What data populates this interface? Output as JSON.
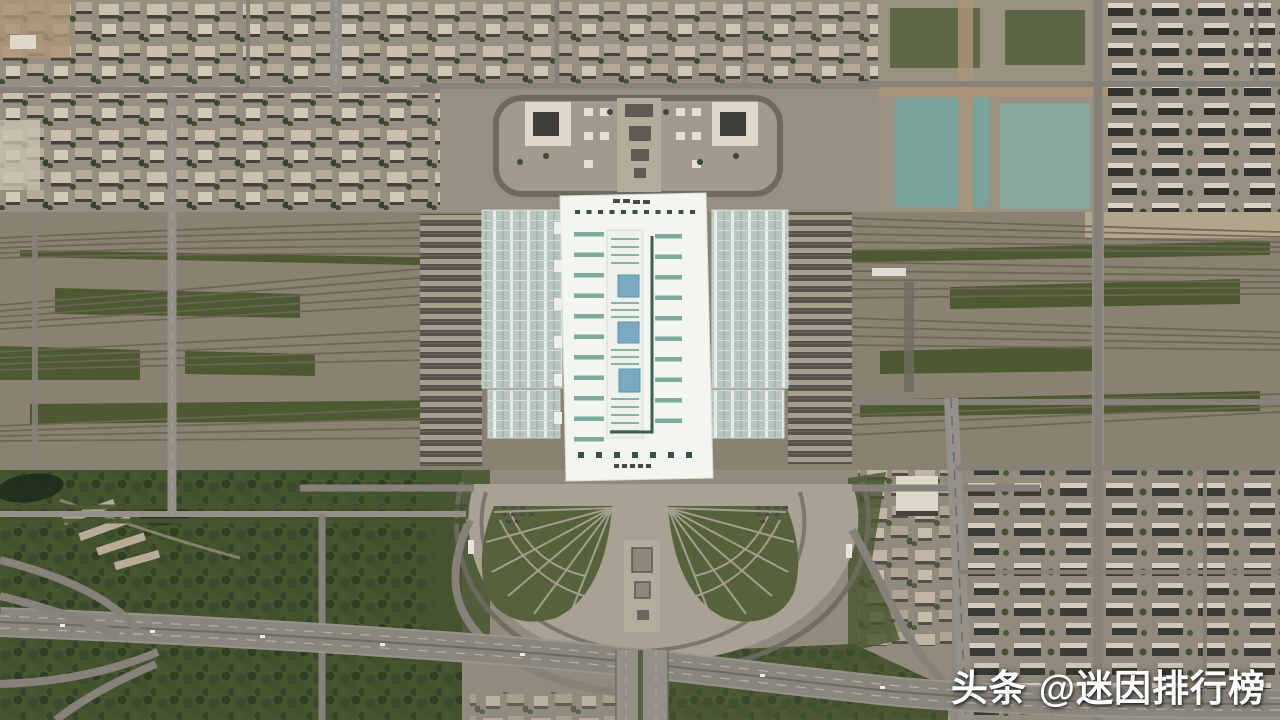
{
  "watermark": {
    "brand": "头条",
    "handle": "@迷因排行榜"
  },
  "scene": {
    "type": "satellite-aerial-photo",
    "subject": "large-railway-station-with-fanning-tracks-and-city"
  },
  "palette": {
    "base": "#928a7d",
    "urbanTop": "#978f82",
    "railBed": "#8b8173",
    "railLine": "#6d6456",
    "greenStrip": "#4d5a31",
    "forest": "#47552f",
    "pond": "#232d1d",
    "roadLight": "#94908a",
    "roadMid": "#86827a",
    "roadDark": "#6e6a62",
    "highway": "#8a867e",
    "laneLine": "#b3b0a8",
    "plaza": "#a8a194",
    "plazaInner": "#a29a8d",
    "promenade": "#b3ab9b",
    "gardenGreen": "#55623c",
    "gardenPath": "#aba496",
    "roofWhite": "#f3f5ef",
    "roofStripe": "#7fab9e",
    "roofDarkLine": "#3d5e52",
    "roofVent": "#4a4843",
    "roofSquare": "#3a4f47",
    "skylight": "#79aac2",
    "centralStrip": "#eef1ea",
    "canopy": "#b7c5be",
    "canopyLine": "#d5ddd6",
    "canopyMullion": "#e6ece7",
    "canopyDark": "#a3b7ae",
    "platformDark": "#57534b",
    "platformLight": "#a69e90",
    "blockLight": "#cbbfae",
    "blockMid": "#b7ab9a",
    "blockPale": "#d3c9b7",
    "shadow": "#45423b",
    "buildingWhite": "#ded8cb",
    "buildingCore": "#3f3d38",
    "dirt": "#ab9478",
    "construction": "#9b9181",
    "conTeal1": "#7ba29a",
    "conTeal2": "#86a79b",
    "tanStrip": "#b5a88f",
    "watermark": "#ffffff"
  }
}
